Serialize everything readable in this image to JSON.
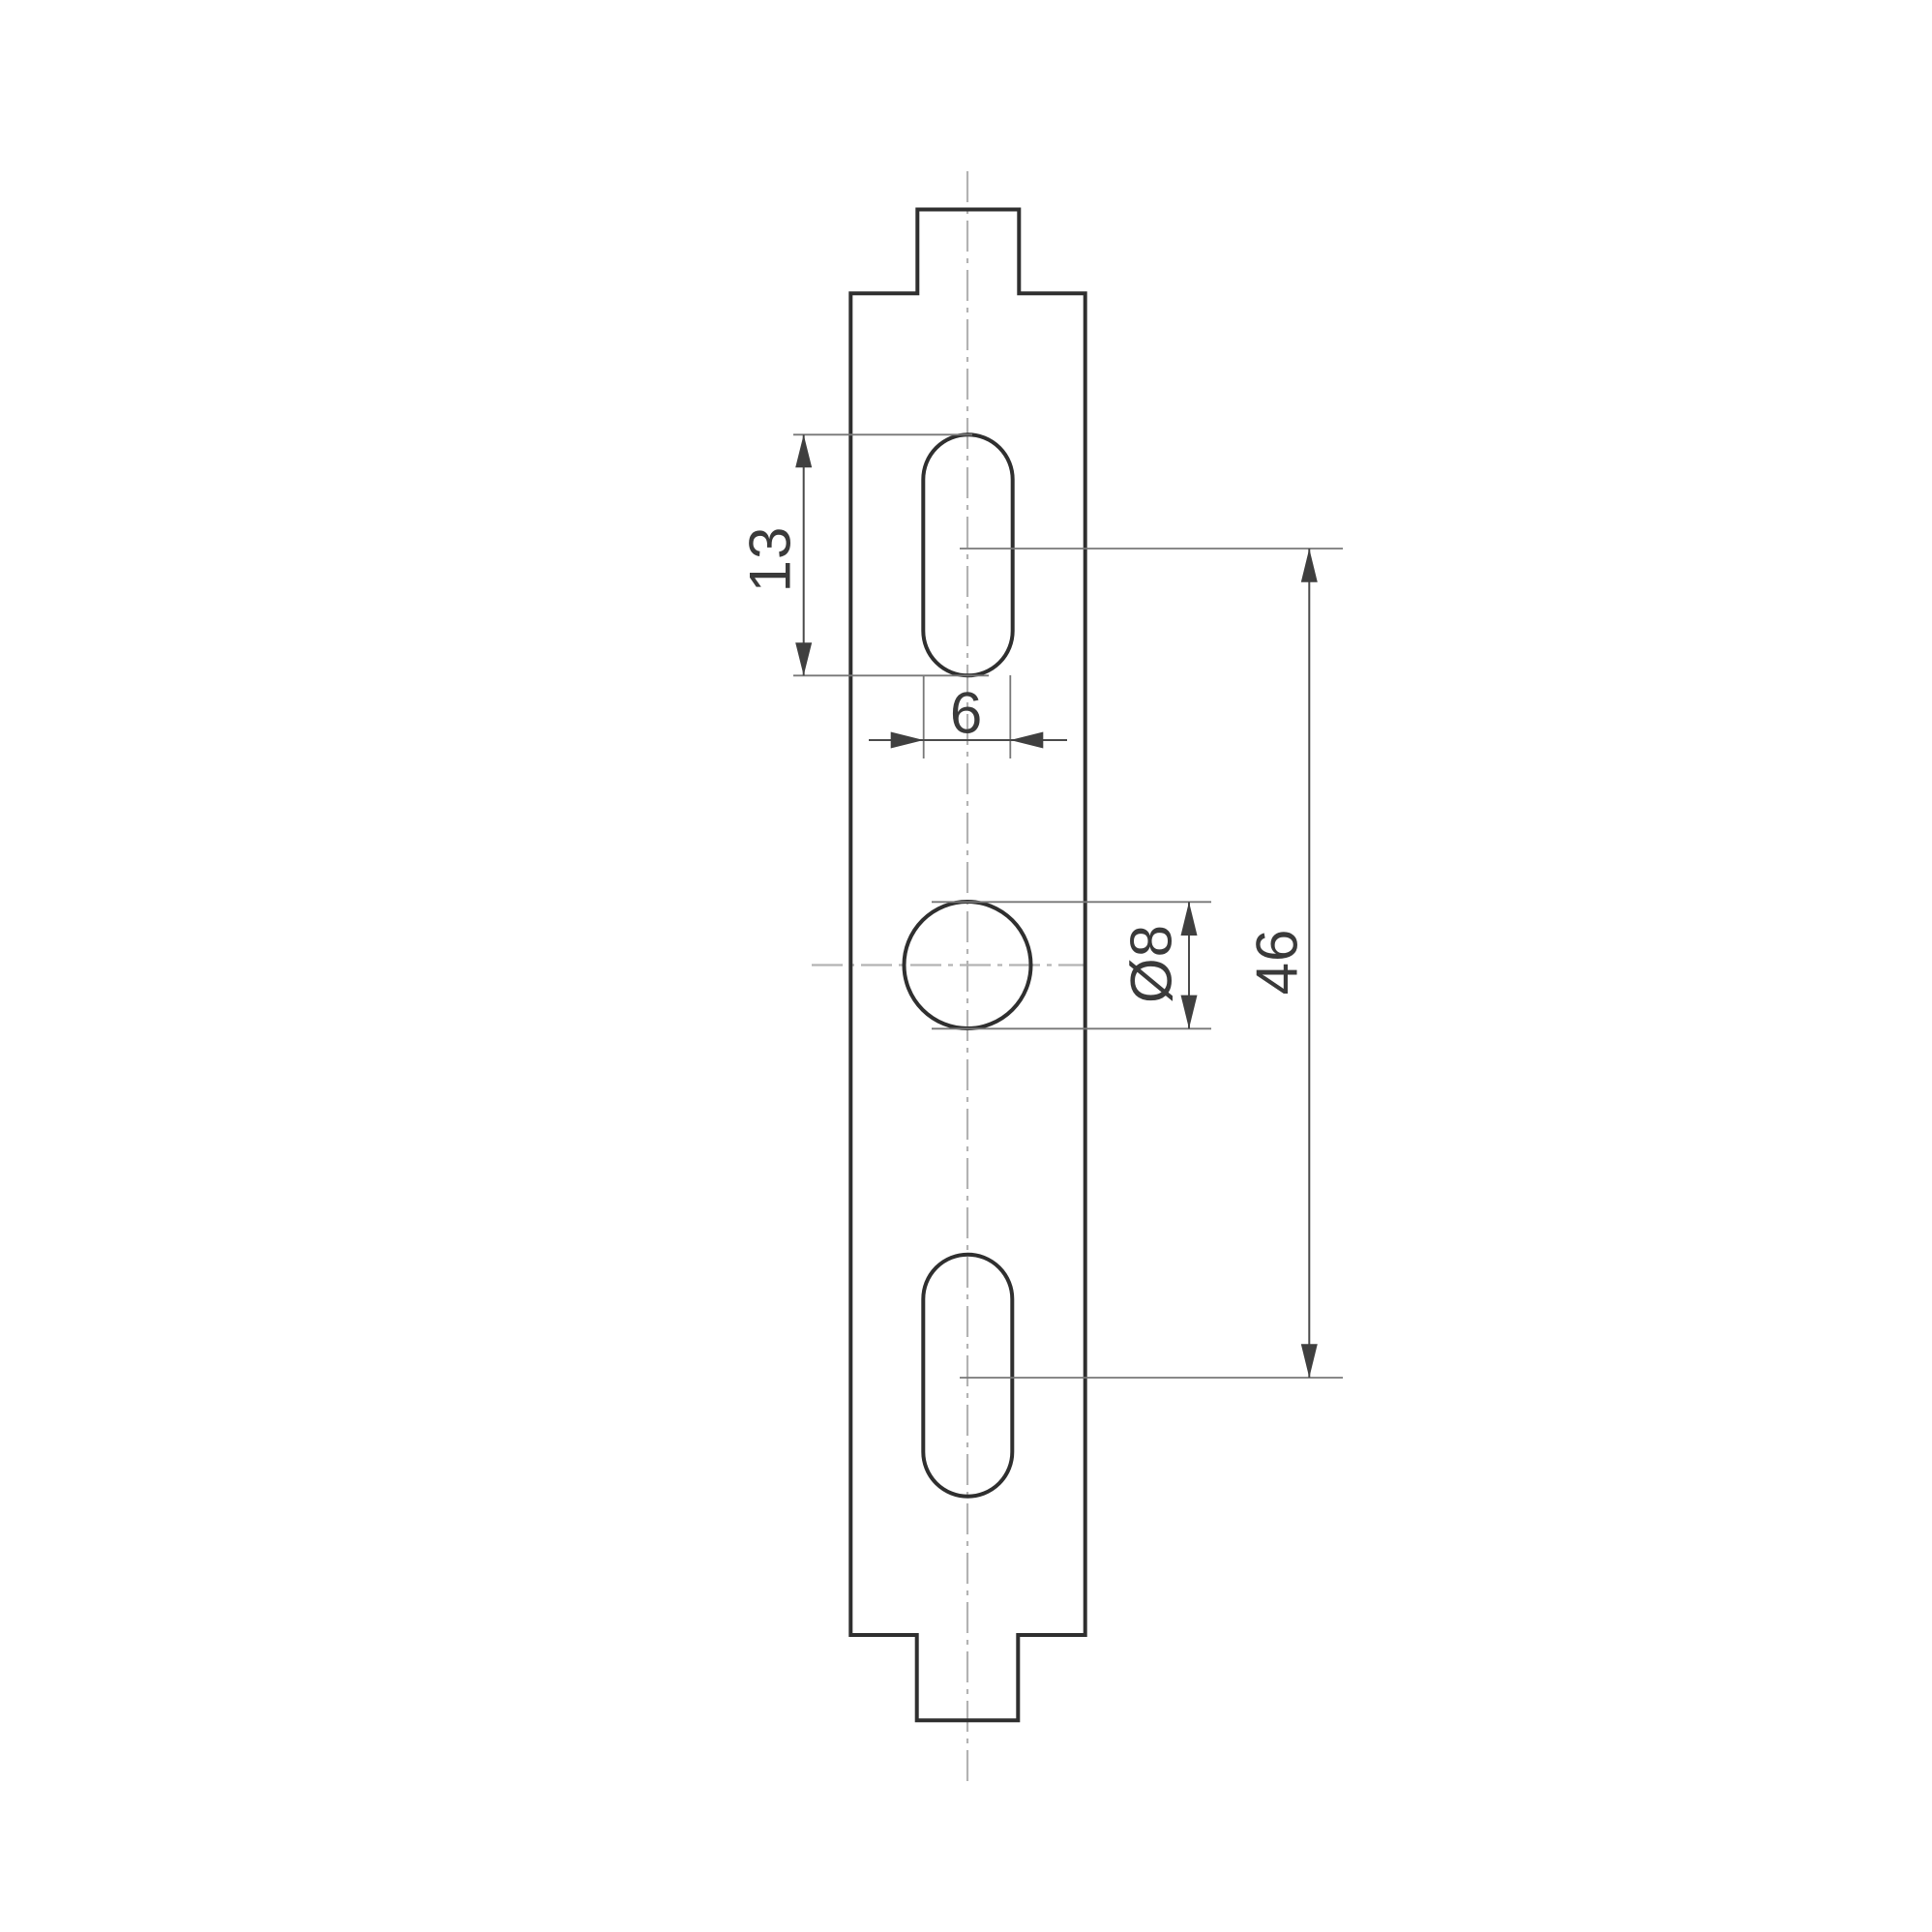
{
  "drawing": {
    "kind": "mounting-strip-profile",
    "dimensions": {
      "slot_length": "13",
      "slot_width": "6",
      "hole_diameter": "Ø8",
      "slot_spacing": "46"
    },
    "colors": {
      "background": "#ffffff",
      "outline": "#2f2f2f",
      "dimension_line": "#4a4a4a",
      "extension_line": "#787878",
      "centerline": "#b3b3b3",
      "text": "#3a3a3a"
    }
  }
}
